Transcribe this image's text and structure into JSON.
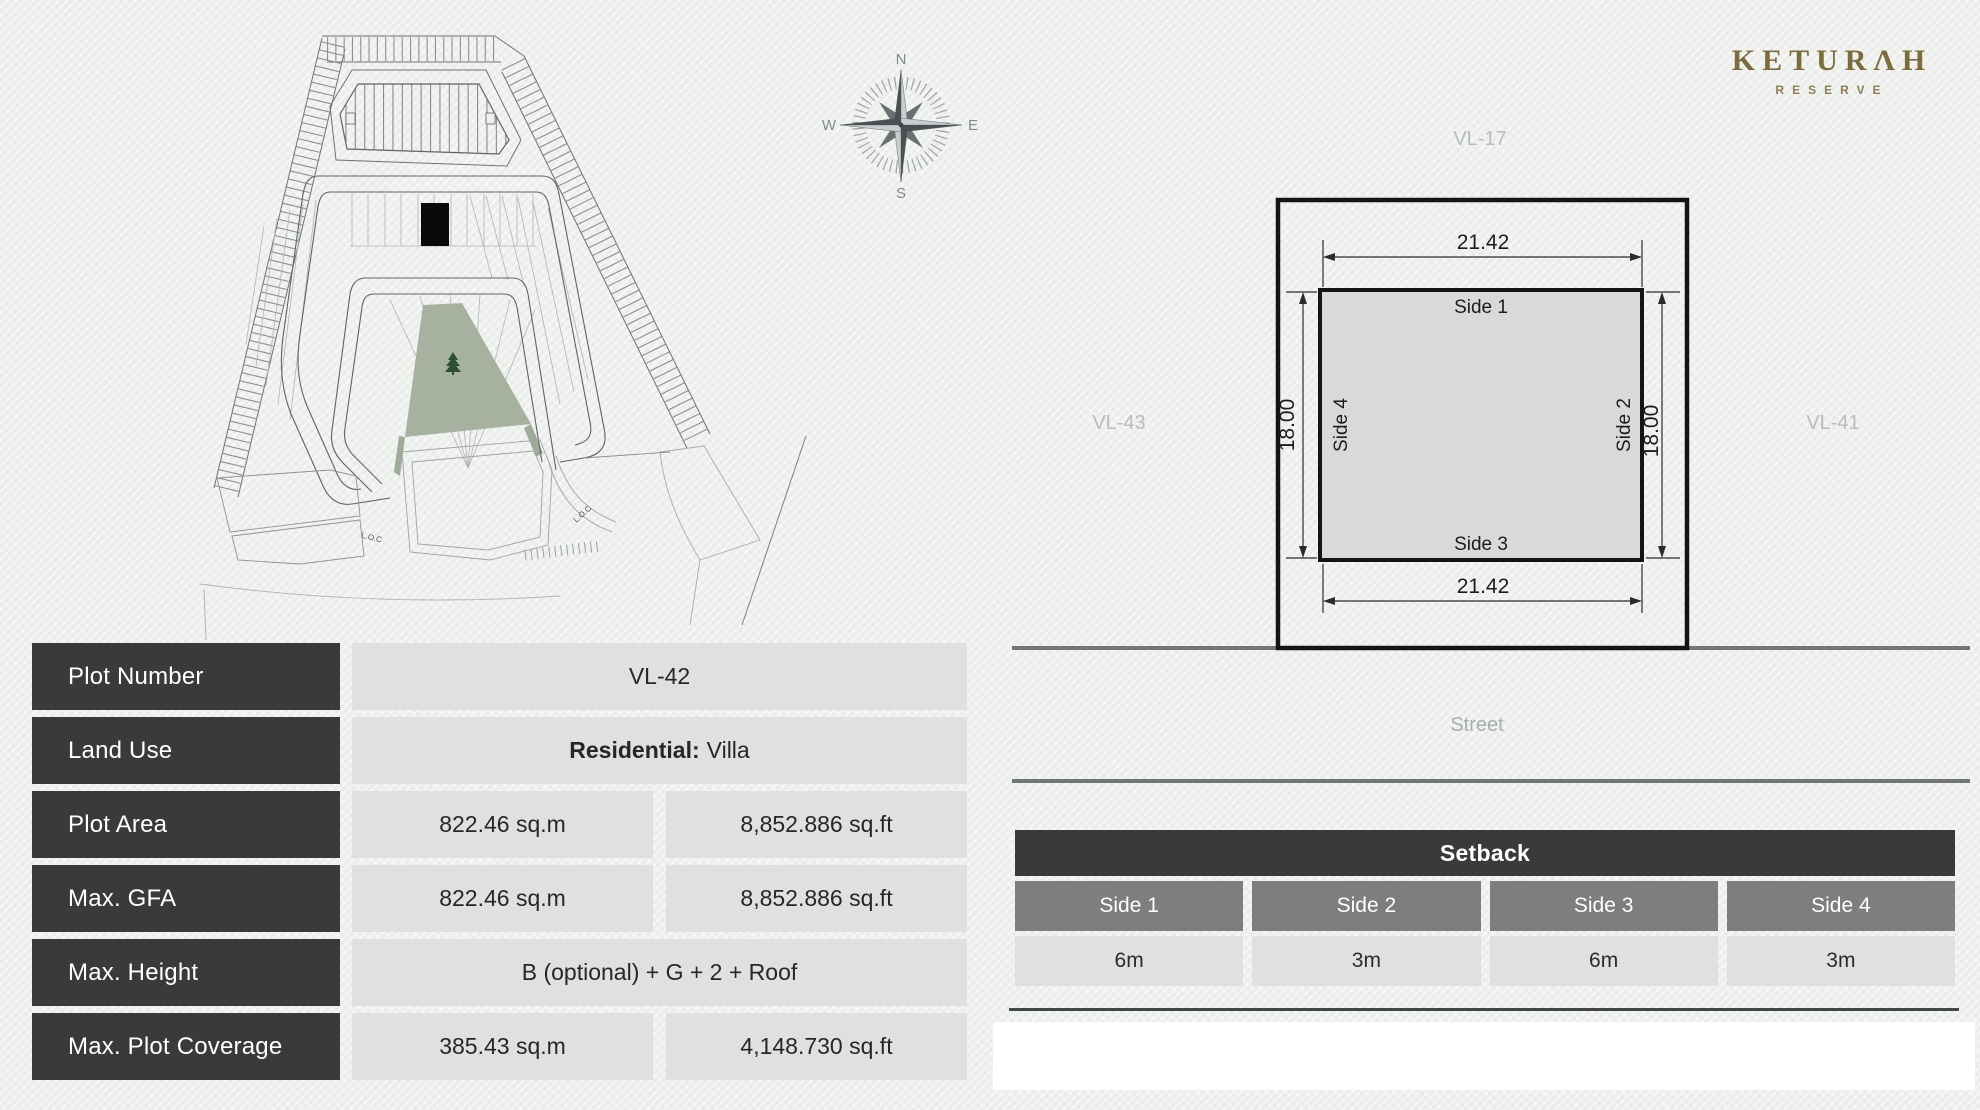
{
  "brand": {
    "title": "KETURΛH",
    "subtitle": "RESERVE"
  },
  "compass": {
    "n": "N",
    "e": "E",
    "s": "S",
    "w": "W"
  },
  "map": {
    "loc1": "L.O.C",
    "loc2": "L.O.C"
  },
  "diagram": {
    "neighbor_top": "VL-17",
    "neighbor_left": "VL-43",
    "neighbor_right": "VL-41",
    "street": "Street",
    "dim_top": "21.42",
    "dim_bottom": "21.42",
    "dim_left": "18.00",
    "dim_right": "18.00",
    "side1": "Side 1",
    "side2": "Side 2",
    "side3": "Side 3",
    "side4": "Side 4"
  },
  "info": {
    "rows": [
      {
        "label": "Plot Number",
        "value": "VL-42"
      },
      {
        "label": "Land Use",
        "value_bold": "Residential:",
        "value_rest": "Villa"
      },
      {
        "label": "Plot Area",
        "sqm": "822.46 sq.m",
        "sqft": "8,852.886 sq.ft"
      },
      {
        "label": "Max. GFA",
        "sqm": "822.46 sq.m",
        "sqft": "8,852.886 sq.ft"
      },
      {
        "label": "Max. Height",
        "value": "B (optional) + G + 2 + Roof"
      },
      {
        "label": "Max. Plot Coverage",
        "sqm": "385.43 sq.m",
        "sqft": "4,148.730 sq.ft"
      }
    ]
  },
  "setback": {
    "title": "Setback",
    "columns": [
      "Side 1",
      "Side 2",
      "Side 3",
      "Side 4"
    ],
    "values": [
      "6m",
      "3m",
      "6m",
      "3m"
    ]
  },
  "colors": {
    "accent_gold": "#7c6c3e",
    "cell_dark": "#3a3a3a",
    "cell_mid": "#7e7e7e",
    "cell_light": "#e0e0e0",
    "plot_green": "#a6b1a0",
    "street_line": "#72767a"
  }
}
